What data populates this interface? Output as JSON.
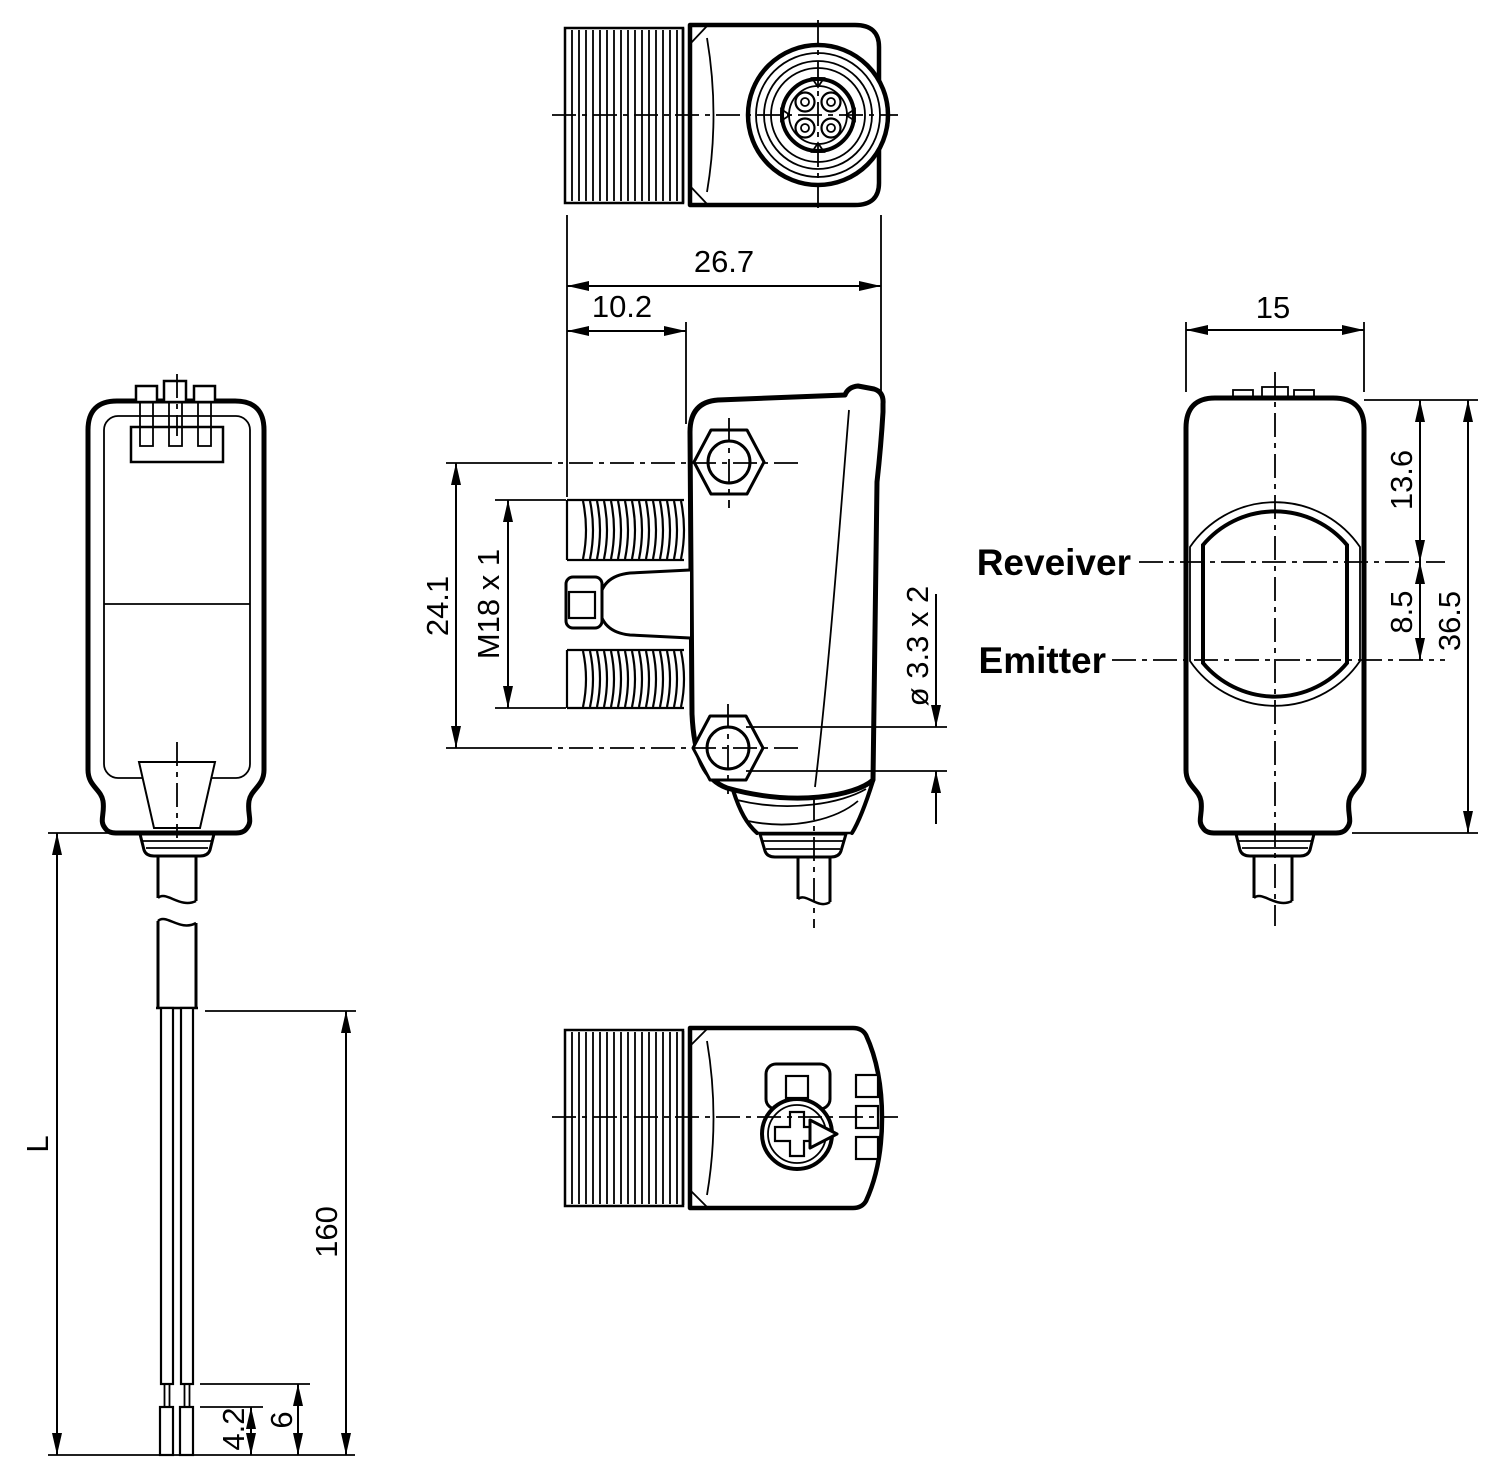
{
  "drawing": {
    "background": "#ffffff",
    "line_color": "#000000",
    "dims": {
      "overall_width": "26.7",
      "thread_length": "10.2",
      "hole_pitch": "24.1",
      "thread_size": "M18 x 1",
      "mounting_holes": "ø 3.3 x 2",
      "housing_width": "15",
      "receiver_offset": "13.6",
      "optic_spacing": "8.5",
      "housing_height": "36.5",
      "cable_length": "L",
      "conductor_length": "160",
      "ferrule_length": "4.2",
      "strip_length": "6"
    },
    "labels": {
      "receiver": "Reveiver",
      "emitter": "Emitter"
    }
  }
}
